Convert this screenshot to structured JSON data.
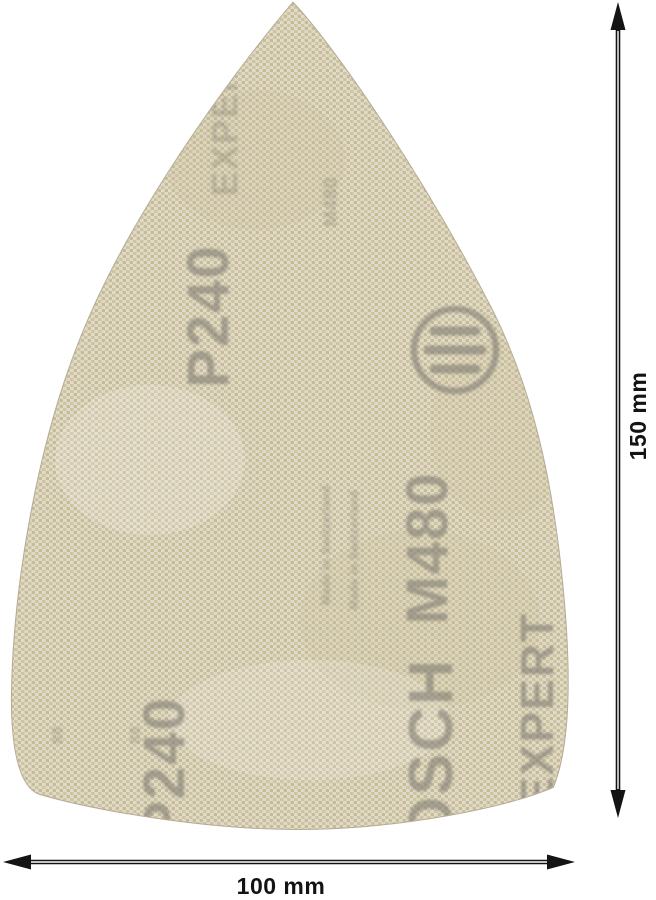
{
  "image_type": "product-photo-with-dimensions",
  "sheet": {
    "product": "triangular mesh sanding sheet",
    "grit_label": "P240",
    "model_label": "M480",
    "brand_label": "BOSCH",
    "line_label": "EXPERT",
    "origin_label": "Made in Switzerland",
    "mark_label": "88",
    "logo_icon": "bosch-armature-logo",
    "colors": {
      "mesh_base": "#d8d1bc",
      "weave_light": "#e8e4d8",
      "weave_tan_a": "#cdc3a0",
      "weave_tan_b": "#c7bb95",
      "print_gray": "#7f7c72",
      "edge": "#b5ac94"
    }
  },
  "dimensions": {
    "height_label": "150 mm",
    "width_label": "100 mm",
    "line_color": "#141414",
    "background": "#ffffff"
  }
}
